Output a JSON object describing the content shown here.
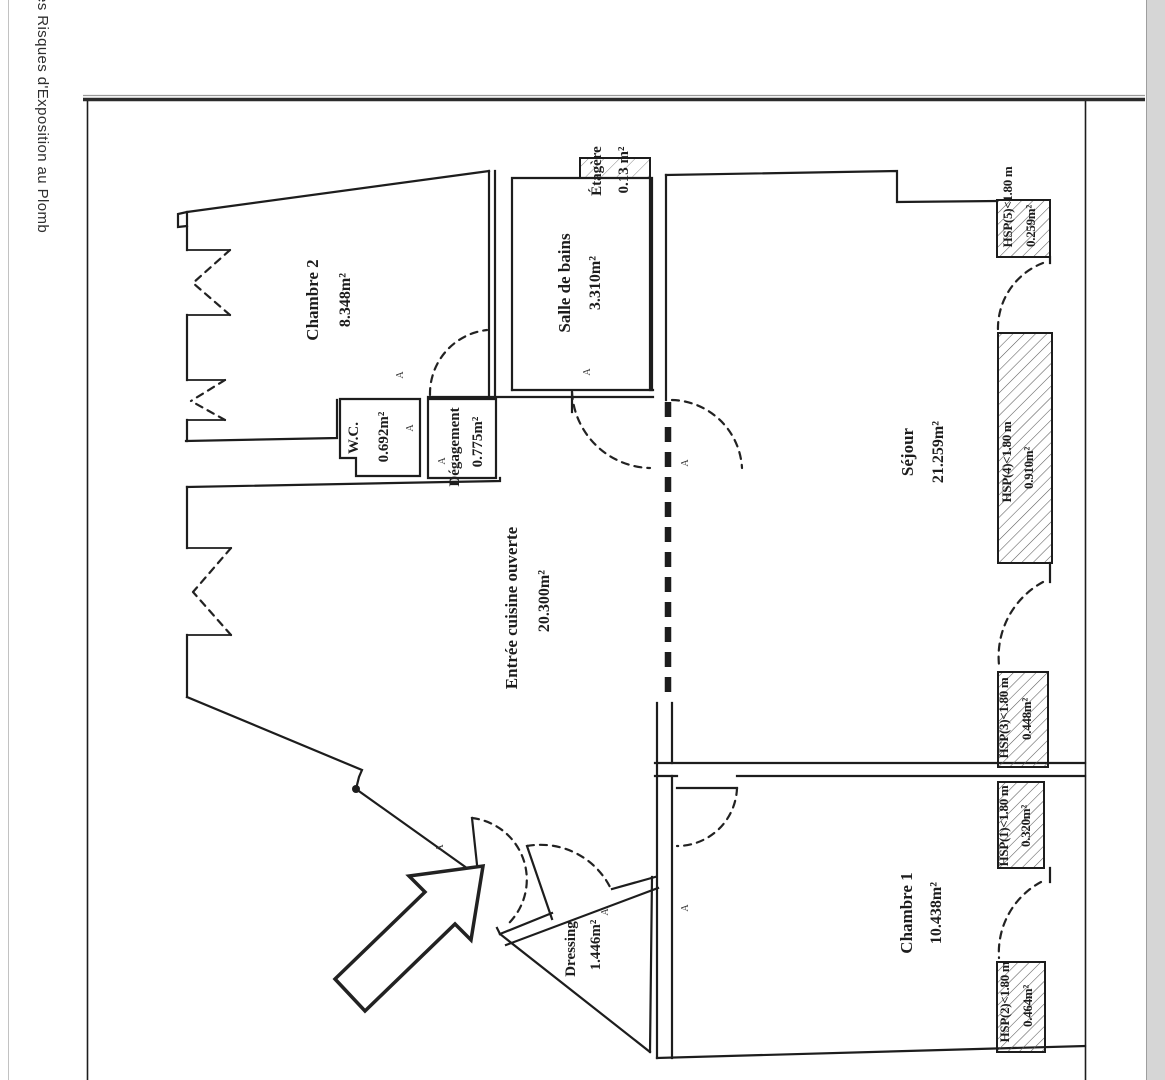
{
  "sidebar": {
    "text_fragment": "es Risques d'Exposition au Plomb"
  },
  "plan": {
    "marker": "A",
    "rooms": [
      {
        "id": "chambre2",
        "name": "Chambre 2",
        "area": "8.348m²"
      },
      {
        "id": "wc",
        "name": "W.C.",
        "area": "0.692m²"
      },
      {
        "id": "degagement",
        "name": "Dégagement",
        "area": "0.775m²"
      },
      {
        "id": "salle_de_bains",
        "name": "Salle de bains",
        "area": "3.310m²"
      },
      {
        "id": "etagere",
        "name": "Étagère",
        "area": "0.13 m²"
      },
      {
        "id": "entree",
        "name": "Entrée cuisine ouverte",
        "area": "20.300m²"
      },
      {
        "id": "sejour",
        "name": "Séjour",
        "area": "21.259m²"
      },
      {
        "id": "chambre1",
        "name": "Chambre 1",
        "area": "10.438m²"
      },
      {
        "id": "dressing",
        "name": "Dressing",
        "area": "1.446m²"
      }
    ],
    "hsp_zones": [
      {
        "id": "hsp5",
        "label": "HSP(5)<1.80 m",
        "area": "0.259m²"
      },
      {
        "id": "hsp4",
        "label": "HSP(4)<1.80 m",
        "area": "0.910m²"
      },
      {
        "id": "hsp3",
        "label": "HSP(3)<1.80 m",
        "area": "0.448m²"
      },
      {
        "id": "hsp1",
        "label": "HSP(1)<1.80 m",
        "area": "0.320m²"
      },
      {
        "id": "hsp2",
        "label": "HSP(2)<1.80 m",
        "area": "0.464m²"
      }
    ]
  },
  "colors": {
    "ink": "#1d1d1d",
    "paper": "#ffffff",
    "scrollbar": "#d6d6d6"
  }
}
